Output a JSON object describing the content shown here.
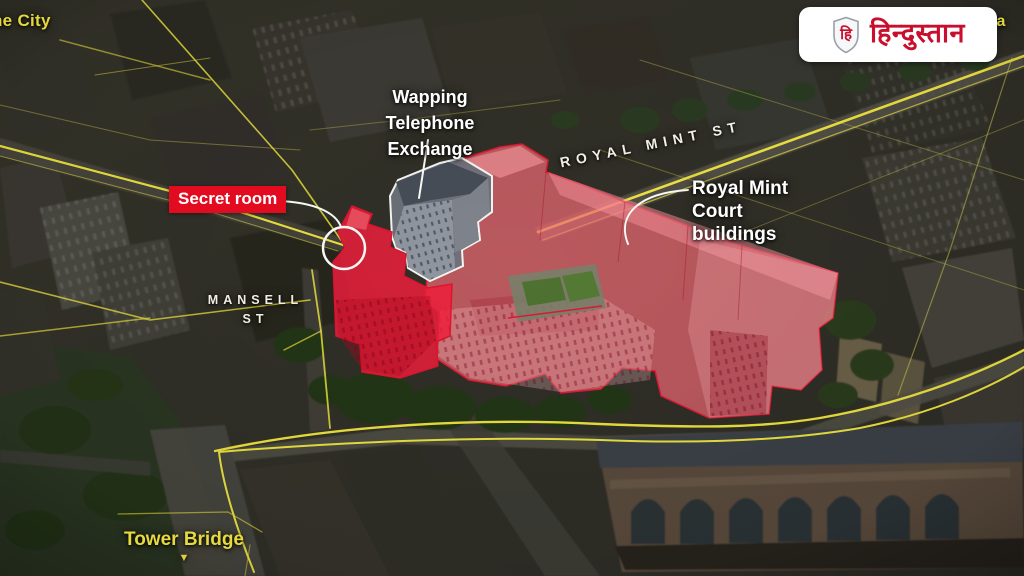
{
  "brand": {
    "name": "हिन्दुस्तान",
    "monogram": "हि"
  },
  "map_labels": {
    "the_city": "he City",
    "cable_st": "Ca",
    "wapping_exchange": "Wapping Telephone Exchange",
    "secret_room": "Secret room",
    "royal_mint_st": "ROYAL MINT ST",
    "royal_mint_court": "Royal Mint Court buildings",
    "mansell_st": "MANSELL ST",
    "tower_bridge": "Tower Bridge"
  },
  "icons": {
    "tower_bridge_arrow": "▼",
    "brand_shield": "shield"
  },
  "colors": {
    "road_yellow": "#e4d83d",
    "highlight_red_fill": "#ef6a74",
    "highlight_red_bright": "#ee1f3c",
    "highlight_red_stroke": "#dc1a32",
    "badge_red": "#e30b1f",
    "brand_red": "#c8102e",
    "outline_white": "#f5f5f2",
    "street_label": "#f2efe4"
  }
}
